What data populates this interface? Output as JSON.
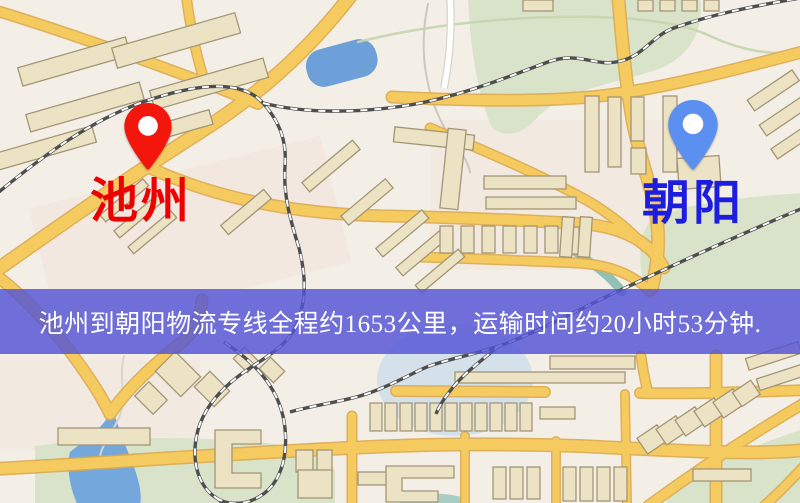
{
  "banner": {
    "text": "池州到朝阳物流专线全程约1653公里，运输时间约20小时53分钟.",
    "background": "rgba(83,83,214,0.82)",
    "text_color": "#ffffff"
  },
  "markers": {
    "origin": {
      "label": "池州",
      "pin_color": "#f3160c",
      "label_color": "#ee0000"
    },
    "destination": {
      "label": "朝阳",
      "pin_color": "#5b8ff0",
      "label_color": "#1d1de0"
    }
  },
  "map_palette": {
    "background": "#f4efe6",
    "road_major": "#f5ca5f",
    "road_casing": "#ddaa4e",
    "park": "#d9e3c9",
    "water": "#6f9fd6",
    "building_fill": "#ece2c4",
    "building_stroke": "#a39676",
    "railway_dark": "#4e4e4e",
    "railway_light": "#ffffff"
  }
}
